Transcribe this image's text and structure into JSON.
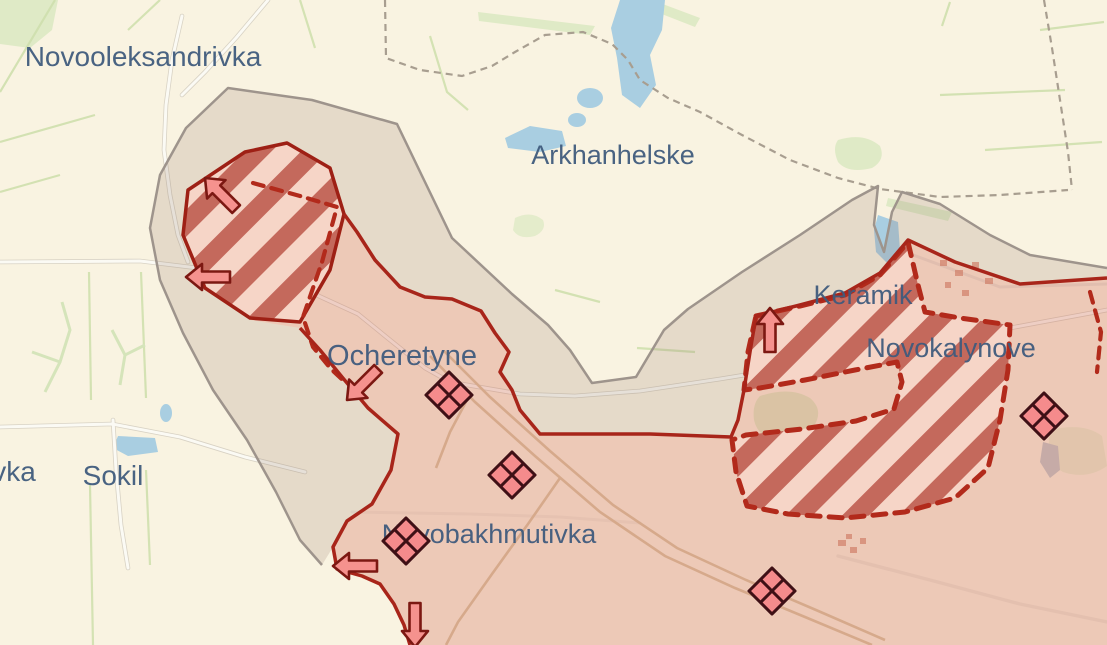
{
  "map": {
    "labels": [
      {
        "id": "novooleksandrivka",
        "text": "Novooleksandrivka"
      },
      {
        "id": "arkhanhelske",
        "text": "Arkhanhelske"
      },
      {
        "id": "ocheretyne",
        "text": "Ocheretyne"
      },
      {
        "id": "keramik",
        "text": "Keramik"
      },
      {
        "id": "novokalynove",
        "text": "Novokalynove"
      },
      {
        "id": "sokil",
        "text": "Sokil"
      },
      {
        "id": "novobakhmutivka",
        "text": "Novobakhmutivka"
      },
      {
        "id": "partial-town-west-edge",
        "text": "vka"
      }
    ],
    "colors": {
      "base_terrain": "#f9f3e1",
      "field_line_green": "#cfe0ae",
      "forest_patch": "#dfeac6",
      "water": "#a9cee1",
      "railway": "#d8c5a2",
      "buffer_zone_fill": "rgba(150,118,105,0.20)",
      "buffer_zone_border": "#9e948c",
      "occupied_zone_fill": "rgba(210,105,85,0.30)",
      "frontline_solid": "#a8251a",
      "assault_dashed_border": "#b22a1b",
      "assault_stripe_dark": "#c4695c",
      "assault_stripe_light": "#f6d5c7",
      "arrow_fill": "#f5928e",
      "arrow_outline": "#7c1812",
      "marker_fill": "#f58b8c",
      "marker_outline": "#3f1016",
      "label_text": "#3f5b7c"
    },
    "symbols": {
      "unit_marker": "quartered-diamond",
      "advance_arrow": "thick-outline-arrow"
    },
    "arrows": [
      {
        "id": "arrow-nw",
        "direction": "northwest"
      },
      {
        "id": "arrow-w-upper",
        "direction": "west"
      },
      {
        "id": "arrow-sw-ocheretyne",
        "direction": "southwest"
      },
      {
        "id": "arrow-n-keramik",
        "direction": "north"
      },
      {
        "id": "arrow-w-novobakhmutivka",
        "direction": "west"
      },
      {
        "id": "arrow-s-bottom",
        "direction": "south"
      }
    ],
    "markers": [
      {
        "id": "diamond-ocheretyne"
      },
      {
        "id": "diamond-south-ocheretyne"
      },
      {
        "id": "diamond-novobakhmutivka"
      },
      {
        "id": "diamond-rail-southeast"
      },
      {
        "id": "diamond-east"
      }
    ]
  }
}
